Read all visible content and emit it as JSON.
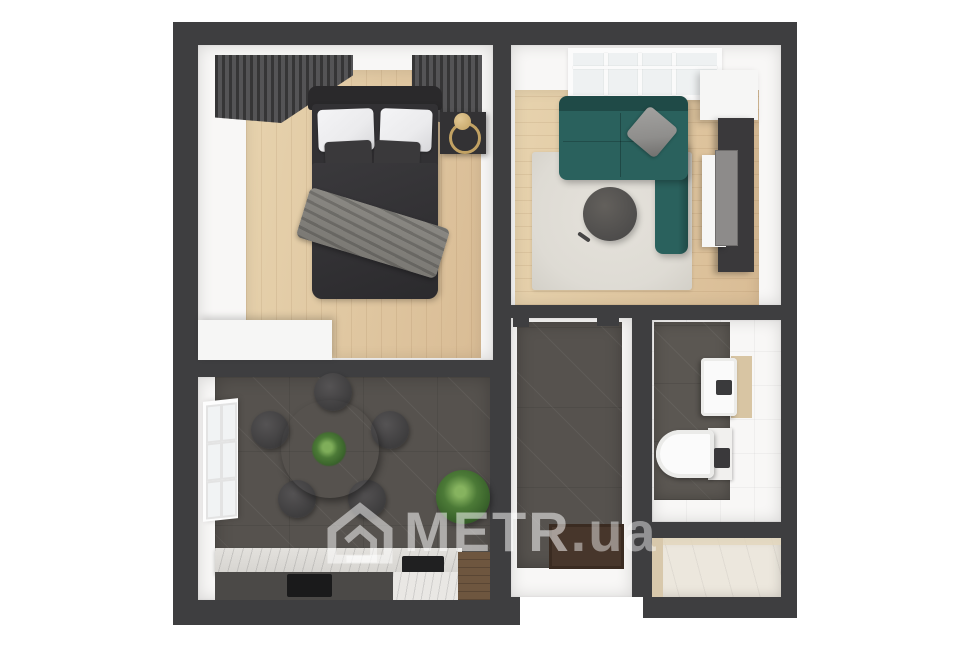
{
  "watermark": {
    "brand": "METR",
    "domain": ".ua",
    "icon": "house-icon"
  },
  "colors": {
    "wall": "#3e3e40",
    "room": "#f8f7f6",
    "wood": "#d9bc95",
    "woodLight": "#e7d3ae",
    "tile": "#56524e",
    "tileBath": "#5b5752",
    "sofa": "#2a615d",
    "rug": "#dedbd4",
    "curtain": "#4a494b",
    "bedDark": "#323134",
    "headboard": "#2a292b",
    "pillowWhite": "#ebebed",
    "pillowDark": "#3a393b",
    "pillowGray": "#8f8e8c",
    "blanket": "#7b7974",
    "nightstand": "#333234",
    "brass": "#c2a263",
    "tableDark": "#464545",
    "chair": "#3e3d3e",
    "plant": "#4c7a37",
    "plantDark": "#355d28",
    "marble": "#d6d4d0",
    "marbleLight": "#e9e7e4",
    "counter": "#4b4947",
    "hob": "#1a1a1b",
    "woodDark": "#6e563f",
    "mat": "#47362b",
    "cream": "#ece7dd",
    "beige": "#d8c8ab",
    "basinPanel": "#d8c5a3",
    "tv": "#3a393b",
    "tvScreen": "#8d8b8a",
    "whitePiece": "#f6f6f5"
  }
}
